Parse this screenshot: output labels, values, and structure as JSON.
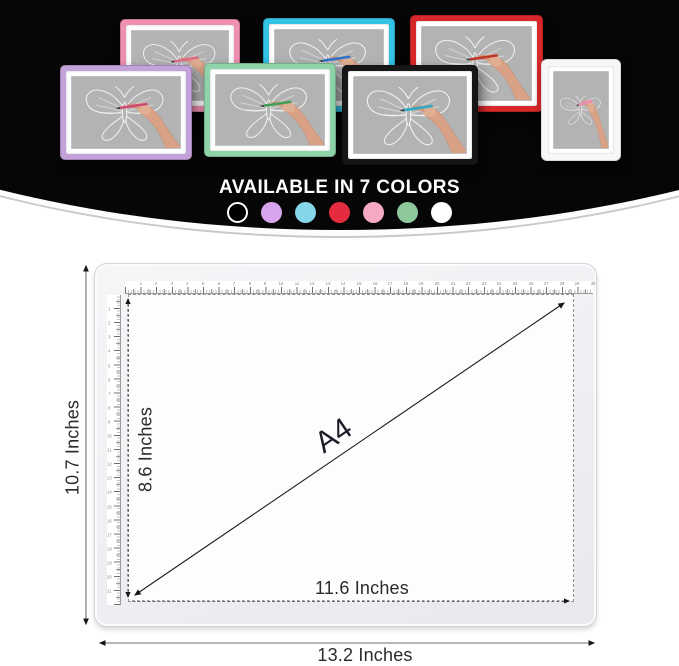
{
  "product": {
    "headline": "AVAILABLE IN 7 COLORS",
    "pads": [
      {
        "name": "pink",
        "frame": "#ef8fb2",
        "pen": "#e06a8a",
        "x": 120,
        "y": 19,
        "w": 120,
        "h": 93,
        "z": 1
      },
      {
        "name": "cyan",
        "frame": "#33c3e5",
        "pen": "#2f72cf",
        "x": 263,
        "y": 18,
        "w": 132,
        "h": 94,
        "z": 1
      },
      {
        "name": "red",
        "frame": "#d9282b",
        "pen": "#c0392b",
        "x": 410,
        "y": 15,
        "w": 133,
        "h": 97,
        "z": 1
      },
      {
        "name": "white",
        "frame": "#f7f7f7",
        "pen": "#ec8fb4",
        "x": 542,
        "y": 60,
        "w": 78,
        "h": 100,
        "z": 1
      },
      {
        "name": "purple",
        "frame": "#c2a2d8",
        "pen": "#cf4a72",
        "x": 60,
        "y": 65,
        "w": 132,
        "h": 95,
        "z": 2
      },
      {
        "name": "green",
        "frame": "#8ed3aa",
        "pen": "#3f9e58",
        "x": 204,
        "y": 63,
        "w": 132,
        "h": 94,
        "z": 2
      },
      {
        "name": "black",
        "frame": "#161616",
        "pen": "#31a9c6",
        "x": 342,
        "y": 65,
        "w": 136,
        "h": 100,
        "z": 2
      }
    ],
    "swatches": [
      {
        "name": "black",
        "fill": "#000000",
        "ring": "#ffffff"
      },
      {
        "name": "lilac",
        "fill": "#d9a4ee"
      },
      {
        "name": "cyan",
        "fill": "#86d6e9"
      },
      {
        "name": "red",
        "fill": "#e52b3e"
      },
      {
        "name": "pink",
        "fill": "#f6a9c3"
      },
      {
        "name": "green",
        "fill": "#8dc79c"
      },
      {
        "name": "white",
        "fill": "#ffffff"
      }
    ]
  },
  "diagram": {
    "size_label": "A4",
    "outer_height_label": "10.7 Inches",
    "outer_width_label": "13.2 Inches",
    "inner_height_label": "8.6 Inches",
    "inner_width_label": "11.6 Inches",
    "ruler_top_units": 30,
    "ruler_left_units": 21
  }
}
